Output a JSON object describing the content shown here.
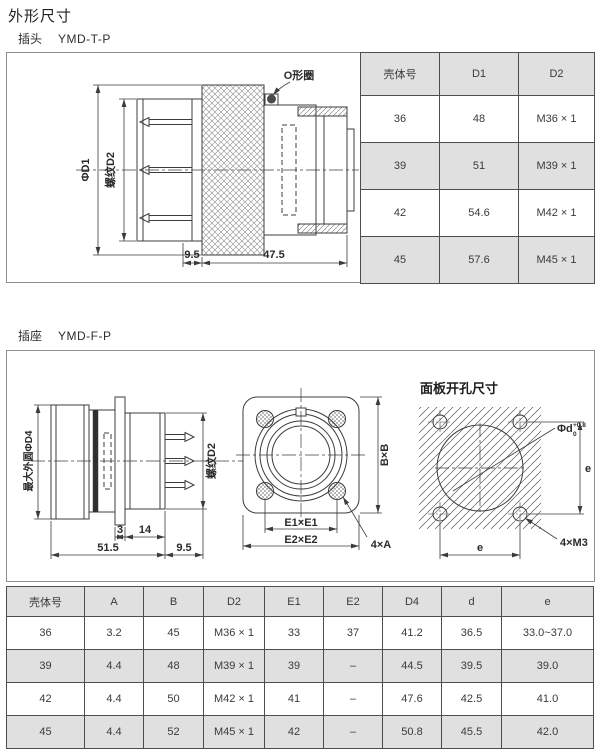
{
  "page_title": "外形尺寸",
  "colors": {
    "table_header_bg": "#e0e0e0",
    "table_border": "#4d4d4d",
    "drawing_line": "#3c3c3c",
    "box_border": "#8f8f8f"
  },
  "plug": {
    "section_label": "插头",
    "model": "YMD-T-P",
    "drawing": {
      "oring_label": "O形圈",
      "dia_label": "ΦD1",
      "thread_label": "螺纹D2",
      "dim_rear": "9.5",
      "dim_length": "47.5"
    },
    "table": {
      "headers": [
        "壳体号",
        "D1",
        "D2"
      ],
      "rows": [
        [
          "36",
          "48",
          "M36 × 1"
        ],
        [
          "39",
          "51",
          "M39 × 1"
        ],
        [
          "42",
          "54.6",
          "M42 × 1"
        ],
        [
          "45",
          "57.6",
          "M45 × 1"
        ]
      ]
    }
  },
  "socket": {
    "section_label": "插座",
    "model": "YMD-F-P",
    "side_drawing": {
      "max_dia_label": "最大外圆ΦD4",
      "thread_label": "螺纹D2",
      "dim_flange": "3",
      "dim_mid": "14",
      "dim_length": "51.5",
      "dim_rear": "9.5"
    },
    "front_drawing": {
      "flange_label": "B×B",
      "spacing_inner_label": "E1×E1",
      "spacing_outer_label": "E2×E2",
      "holes_label": "4×A"
    },
    "panel_drawing": {
      "title": "面板开孔尺寸",
      "hole_dia_label": "Φd",
      "tol_upper": "+0.8",
      "tol_lower": "0",
      "screw_label": "4×M3",
      "dim_v": "e",
      "dim_h": "e"
    },
    "table": {
      "headers": [
        "壳体号",
        "A",
        "B",
        "D2",
        "E1",
        "E2",
        "D4",
        "d",
        "e"
      ],
      "rows": [
        [
          "36",
          "3.2",
          "45",
          "M36 × 1",
          "33",
          "37",
          "41.2",
          "36.5",
          "33.0~37.0"
        ],
        [
          "39",
          "4.4",
          "48",
          "M39 × 1",
          "39",
          "–",
          "44.5",
          "39.5",
          "39.0"
        ],
        [
          "42",
          "4.4",
          "50",
          "M42 × 1",
          "41",
          "–",
          "47.6",
          "42.5",
          "41.0"
        ],
        [
          "45",
          "4.4",
          "52",
          "M45 × 1",
          "42",
          "–",
          "50.8",
          "45.5",
          "42.0"
        ]
      ]
    }
  }
}
